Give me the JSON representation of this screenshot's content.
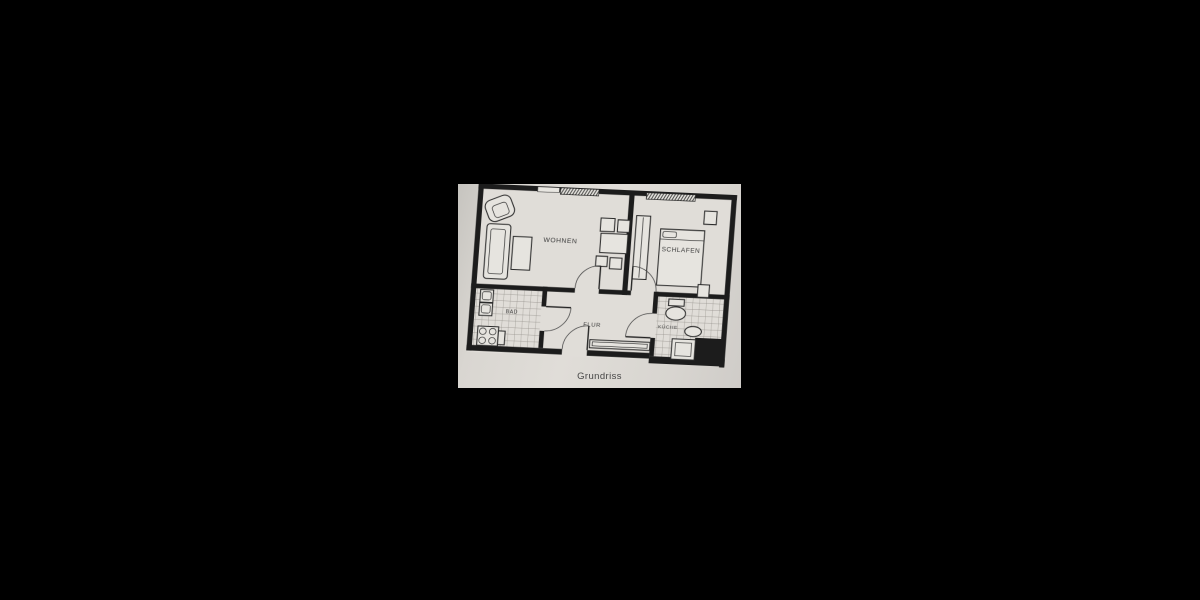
{
  "scene": {
    "background_color": "#000000",
    "paper_color": "#d8d5d0",
    "ink_color": "#1c1c1c",
    "tile_line_color": "#8f8c86"
  },
  "floorplan": {
    "caption": "Grundriss",
    "rooms": [
      {
        "id": "wohnen",
        "label": "WOHNEN"
      },
      {
        "id": "schlafen",
        "label": "SCHLAFEN"
      },
      {
        "id": "bad",
        "label": "BAD"
      },
      {
        "id": "flur",
        "label": "FLUR"
      },
      {
        "id": "kueche",
        "label": "KÜCHE"
      }
    ]
  }
}
